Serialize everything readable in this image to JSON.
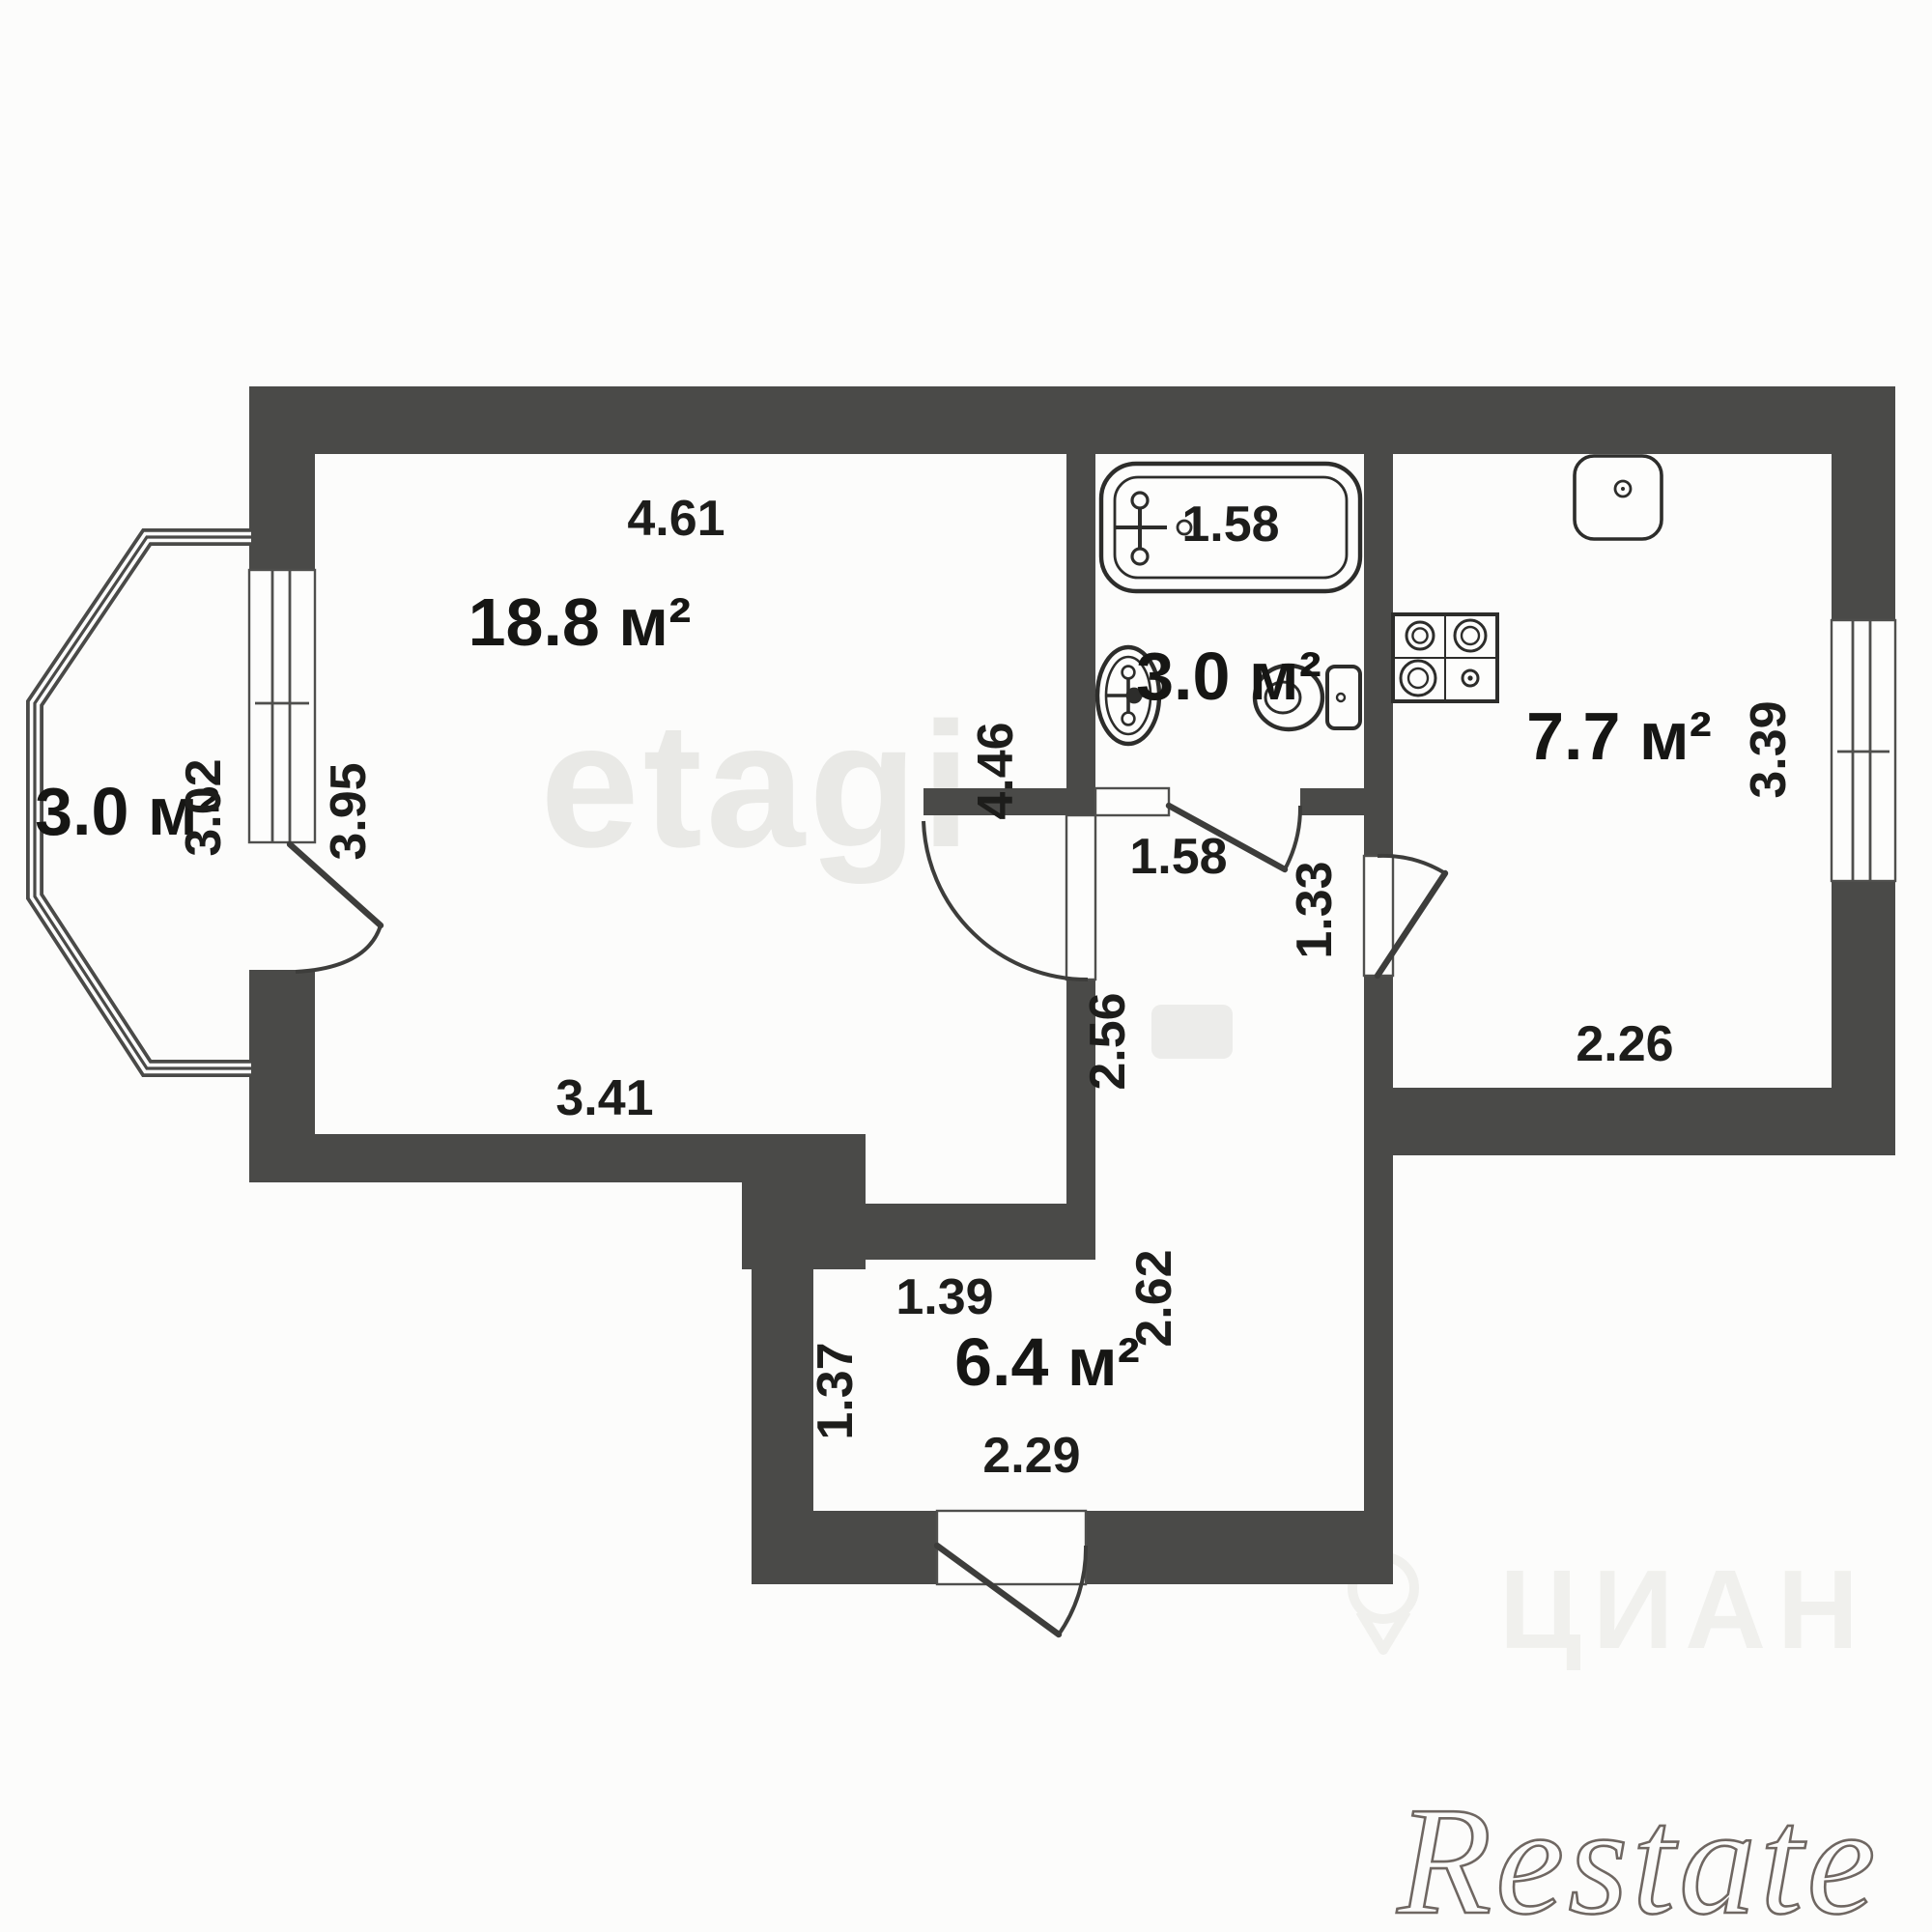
{
  "plan": {
    "type": "apartment-floor-plan",
    "rooms": [
      {
        "name": "living-room",
        "area": "18.8 м²",
        "dimensions": {
          "top": "4.61",
          "left": "3.95",
          "bottom": "3.41",
          "right": "4.46"
        }
      },
      {
        "name": "balcony-bay-window",
        "area": "3.0 м²",
        "dimensions": {
          "depth": "3.02"
        }
      },
      {
        "name": "bathroom",
        "area": "3.0 м²",
        "dimensions": {
          "bathtub": "1.58",
          "door_wall": "1.58"
        }
      },
      {
        "name": "kitchen",
        "area": "7.7 м²",
        "dimensions": {
          "right": "3.39",
          "bottom": "2.26",
          "door": "1.33"
        }
      },
      {
        "name": "hallway",
        "area": "6.4 м²",
        "dimensions": {
          "top": "1.39",
          "left": "1.37",
          "bottom": "2.29",
          "corridor_upper": "2.56",
          "corridor_lower": "2.62"
        }
      }
    ],
    "fixtures": [
      "bathtub",
      "wash-basin",
      "toilet",
      "kitchen-sink",
      "stove-4-burner"
    ],
    "colors": {
      "wall": "#4a4a48",
      "background": "#fcfcfb"
    },
    "watermarks": {
      "etagi": "etagi",
      "cian": "ЦИАН",
      "restate": "Restate"
    }
  }
}
